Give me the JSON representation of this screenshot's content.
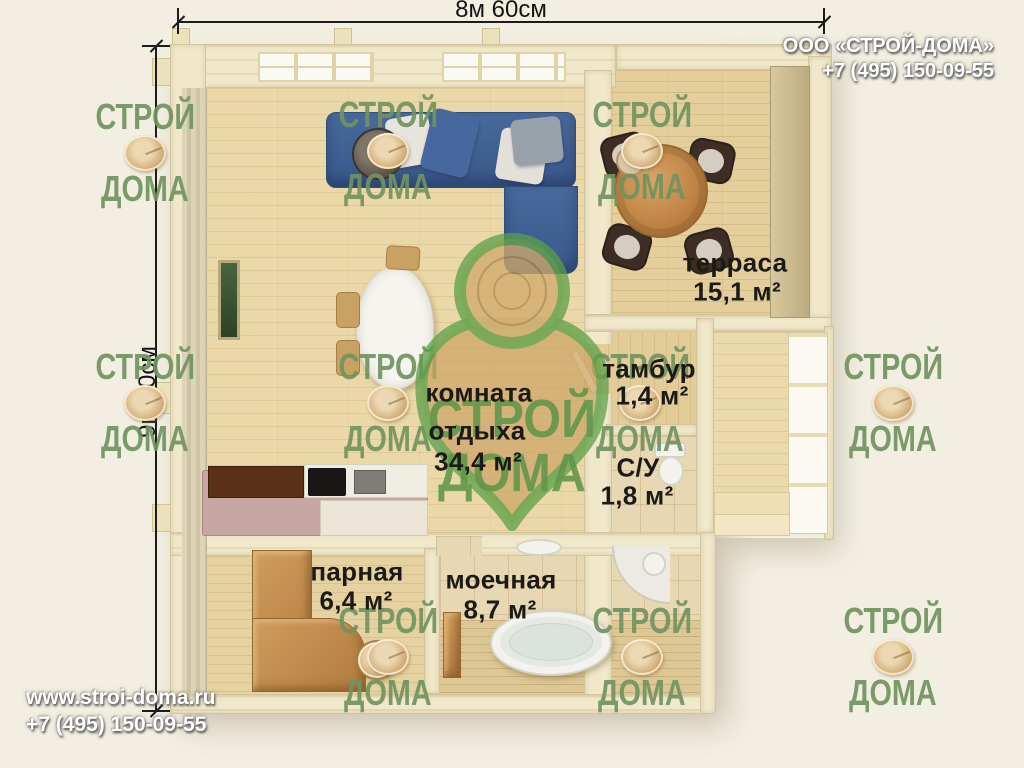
{
  "branding": {
    "company": "ООО «СТРОЙ-ДОМА»",
    "phone": "+7 (495) 150-09-55",
    "website": "www.stroi-doma.ru"
  },
  "dimensions": {
    "width": "8м 60см",
    "height": "9м 10см"
  },
  "watermark": {
    "word1": "СТРОЙ",
    "word2": "ДОМА"
  },
  "logo": {
    "word1": "СТРОЙ",
    "word2": "ДОМА"
  },
  "rooms": {
    "terrace": {
      "name": "терраса",
      "area": "15,1 м²"
    },
    "tambour": {
      "name": "тамбур",
      "area": "1,4 м²"
    },
    "wc": {
      "name": "С/У",
      "area": "1,8 м²"
    },
    "lounge": {
      "name_line1": "комната",
      "name_line2": "отдыха",
      "area": "34,4 м²"
    },
    "steam": {
      "name": "парная",
      "area": "6,4 м²"
    },
    "wash": {
      "name": "моечная",
      "area": "8,7 м²"
    }
  },
  "colors": {
    "background": "#f2eee1",
    "watermark_green": "#7292 60",
    "logo_green": "#4f9448",
    "sofa_blue": "#3e5e92",
    "wall_cream": "#f1e8cb"
  }
}
